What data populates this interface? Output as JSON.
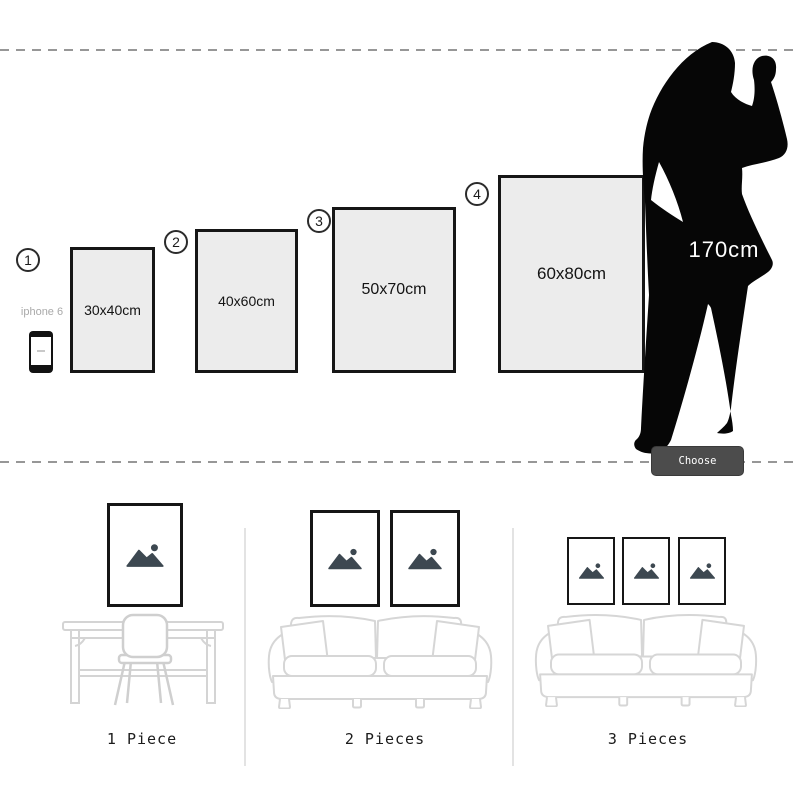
{
  "size_chart": {
    "reference_label": "iphone 6",
    "person_height": "170cm",
    "button_label": "Choose Painting",
    "sizes": [
      {
        "num": "1",
        "label": "30x40cm"
      },
      {
        "num": "2",
        "label": "40x60cm"
      },
      {
        "num": "3",
        "label": "50x70cm"
      },
      {
        "num": "4",
        "label": "60x80cm"
      }
    ]
  },
  "arrangements": [
    {
      "label": "1 Piece",
      "frame_count": 1
    },
    {
      "label": "2 Pieces",
      "frame_count": 2
    },
    {
      "label": "3 Pieces",
      "frame_count": 3
    }
  ],
  "colors": {
    "frame_fill": "#ececec",
    "frame_border": "#161616",
    "silhouette": "#060606",
    "button_bg": "#4c4c4c",
    "mountain_icon": "#3d4851",
    "sketch_line": "#d6d6d6",
    "dash_line": "#979797"
  }
}
